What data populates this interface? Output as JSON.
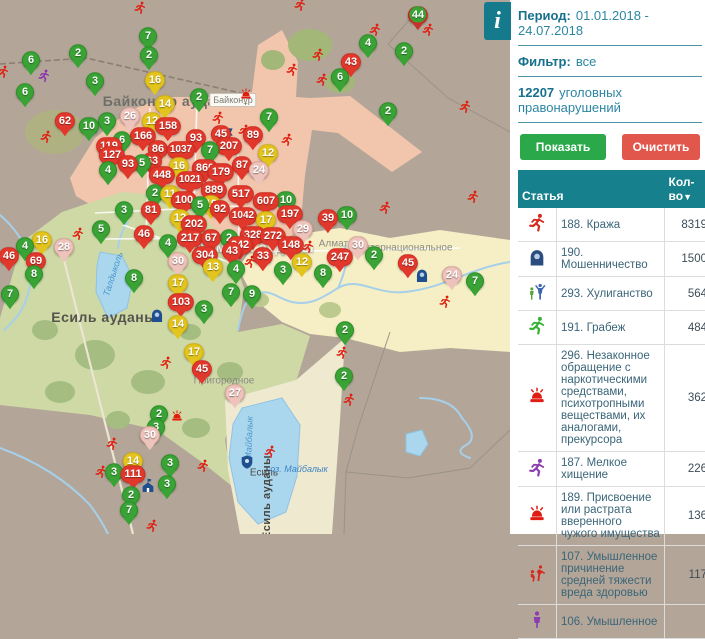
{
  "map": {
    "district_labels": [
      {
        "text": "Байконыр ауданы",
        "x": 170,
        "y": 101,
        "fs": 14,
        "color": "#6f6f6a",
        "rot": 0,
        "shadow": false
      },
      {
        "text": "Алматы ауданы",
        "x": 255,
        "y": 247,
        "fs": 14,
        "color": "#f6f4ec",
        "rot": 0,
        "shadow": true
      },
      {
        "text": "Есиль ауданы",
        "x": 104,
        "y": 317,
        "fs": 14,
        "color": "#55544c",
        "rot": 0,
        "shadow": false
      },
      {
        "text": "Есиль ауданы",
        "x": 267,
        "y": 497,
        "fs": 11,
        "color": "#454540",
        "rot": -90,
        "shadow": false
      }
    ],
    "place_labels": [
      {
        "text": "Байконұр",
        "x": 233,
        "y": 100,
        "fs": 9,
        "color": "#7c7b74",
        "boxed": true
      },
      {
        "text": "Алматы",
        "x": 337,
        "y": 244,
        "fs": 10,
        "color": "#8a8a83"
      },
      {
        "text": "Интернациональное",
        "x": 405,
        "y": 248,
        "fs": 10,
        "color": "#8a8a83"
      },
      {
        "text": "Пригородное",
        "x": 224,
        "y": 381,
        "fs": 10,
        "color": "#8a8a83"
      },
      {
        "text": "Есиль",
        "x": 264,
        "y": 473,
        "fs": 10,
        "color": "#4a4a44"
      },
      {
        "text": "оз. Майбалык",
        "x": 299,
        "y": 469,
        "fs": 9,
        "color": "#3f85c6",
        "italic": true
      },
      {
        "text": "Талдыколь",
        "x": 113,
        "y": 274,
        "fs": 9,
        "color": "#4a97cc",
        "rot": -72,
        "italic": true
      },
      {
        "text": "Майбалык",
        "x": 249,
        "y": 438,
        "fs": 9,
        "color": "#4a97cc",
        "rot": -88,
        "italic": true
      }
    ],
    "markers": [
      {
        "x": 148,
        "y": 38,
        "n": "7",
        "c": "green"
      },
      {
        "x": 149,
        "y": 57,
        "n": "2",
        "c": "green"
      },
      {
        "x": 78,
        "y": 55,
        "n": "2",
        "c": "green"
      },
      {
        "x": 31,
        "y": 62,
        "n": "6",
        "c": "green"
      },
      {
        "x": 25,
        "y": 94,
        "n": "6",
        "c": "green"
      },
      {
        "x": 95,
        "y": 83,
        "n": "3",
        "c": "green"
      },
      {
        "x": 418,
        "y": 17,
        "n": "44",
        "c": "cluster"
      },
      {
        "x": 368,
        "y": 45,
        "n": "4",
        "c": "green"
      },
      {
        "x": 404,
        "y": 53,
        "n": "2",
        "c": "green"
      },
      {
        "x": 351,
        "y": 64,
        "n": "43",
        "c": "red"
      },
      {
        "x": 340,
        "y": 79,
        "n": "6",
        "c": "green"
      },
      {
        "x": 388,
        "y": 113,
        "n": "2",
        "c": "green"
      },
      {
        "x": 155,
        "y": 82,
        "n": "16",
        "c": "yellow"
      },
      {
        "x": 165,
        "y": 106,
        "n": "14",
        "c": "yellow"
      },
      {
        "x": 199,
        "y": 99,
        "n": "2",
        "c": "green"
      },
      {
        "x": 269,
        "y": 119,
        "n": "7",
        "c": "green"
      },
      {
        "x": 130,
        "y": 118,
        "n": "26",
        "c": "pale"
      },
      {
        "x": 107,
        "y": 123,
        "n": "3",
        "c": "green"
      },
      {
        "x": 152,
        "y": 123,
        "n": "12",
        "c": "yellow"
      },
      {
        "x": 168,
        "y": 128,
        "n": "158",
        "c": "red"
      },
      {
        "x": 65,
        "y": 123,
        "n": "62",
        "c": "red"
      },
      {
        "x": 89,
        "y": 128,
        "n": "10",
        "c": "green"
      },
      {
        "x": 143,
        "y": 138,
        "n": "166",
        "c": "red"
      },
      {
        "x": 196,
        "y": 140,
        "n": "93",
        "c": "red"
      },
      {
        "x": 221,
        "y": 136,
        "n": "45",
        "c": "red"
      },
      {
        "x": 229,
        "y": 148,
        "n": "207",
        "c": "red"
      },
      {
        "x": 253,
        "y": 137,
        "n": "89",
        "c": "red"
      },
      {
        "x": 122,
        "y": 142,
        "n": "6",
        "c": "green"
      },
      {
        "x": 109,
        "y": 148,
        "n": "119",
        "c": "red"
      },
      {
        "x": 112,
        "y": 157,
        "n": "127",
        "c": "red"
      },
      {
        "x": 158,
        "y": 151,
        "n": "86",
        "c": "red"
      },
      {
        "x": 181,
        "y": 152,
        "n": "1037",
        "c": "red"
      },
      {
        "x": 210,
        "y": 152,
        "n": "7",
        "c": "green"
      },
      {
        "x": 152,
        "y": 163,
        "n": "63",
        "c": "red"
      },
      {
        "x": 128,
        "y": 166,
        "n": "93",
        "c": "red"
      },
      {
        "x": 268,
        "y": 155,
        "n": "12",
        "c": "yellow"
      },
      {
        "x": 259,
        "y": 172,
        "n": "24",
        "c": "pale"
      },
      {
        "x": 242,
        "y": 167,
        "n": "87",
        "c": "red"
      },
      {
        "x": 142,
        "y": 165,
        "n": "5",
        "c": "green"
      },
      {
        "x": 179,
        "y": 168,
        "n": "16",
        "c": "yellow"
      },
      {
        "x": 205,
        "y": 170,
        "n": "860",
        "c": "red"
      },
      {
        "x": 221,
        "y": 174,
        "n": "179",
        "c": "red"
      },
      {
        "x": 108,
        "y": 172,
        "n": "4",
        "c": "green"
      },
      {
        "x": 162,
        "y": 177,
        "n": "448",
        "c": "red"
      },
      {
        "x": 190,
        "y": 182,
        "n": "1021",
        "c": "red"
      },
      {
        "x": 214,
        "y": 192,
        "n": "889",
        "c": "red"
      },
      {
        "x": 241,
        "y": 196,
        "n": "517",
        "c": "red"
      },
      {
        "x": 155,
        "y": 195,
        "n": "2",
        "c": "green"
      },
      {
        "x": 170,
        "y": 196,
        "n": "11",
        "c": "yellow"
      },
      {
        "x": 184,
        "y": 202,
        "n": "100",
        "c": "red"
      },
      {
        "x": 266,
        "y": 203,
        "n": "607",
        "c": "red"
      },
      {
        "x": 286,
        "y": 202,
        "n": "10",
        "c": "green"
      },
      {
        "x": 200,
        "y": 207,
        "n": "5",
        "c": "green"
      },
      {
        "x": 211,
        "y": 206,
        "n": "19",
        "c": "yellow"
      },
      {
        "x": 220,
        "y": 211,
        "n": "92",
        "c": "red"
      },
      {
        "x": 290,
        "y": 216,
        "n": "197",
        "c": "red"
      },
      {
        "x": 243,
        "y": 218,
        "n": "1042",
        "c": "red"
      },
      {
        "x": 124,
        "y": 212,
        "n": "3",
        "c": "green"
      },
      {
        "x": 151,
        "y": 212,
        "n": "81",
        "c": "red"
      },
      {
        "x": 328,
        "y": 220,
        "n": "39",
        "c": "red"
      },
      {
        "x": 347,
        "y": 217,
        "n": "10",
        "c": "green"
      },
      {
        "x": 180,
        "y": 220,
        "n": "12",
        "c": "yellow"
      },
      {
        "x": 266,
        "y": 222,
        "n": "17",
        "c": "yellow"
      },
      {
        "x": 194,
        "y": 226,
        "n": "202",
        "c": "red"
      },
      {
        "x": 303,
        "y": 231,
        "n": "29",
        "c": "pale"
      },
      {
        "x": 101,
        "y": 231,
        "n": "5",
        "c": "green"
      },
      {
        "x": 144,
        "y": 236,
        "n": "46",
        "c": "red"
      },
      {
        "x": 229,
        "y": 240,
        "n": "2",
        "c": "green"
      },
      {
        "x": 253,
        "y": 237,
        "n": "328",
        "c": "red"
      },
      {
        "x": 273,
        "y": 238,
        "n": "272",
        "c": "red"
      },
      {
        "x": 42,
        "y": 242,
        "n": "16",
        "c": "yellow"
      },
      {
        "x": 25,
        "y": 248,
        "n": "4",
        "c": "green"
      },
      {
        "x": 64,
        "y": 249,
        "n": "28",
        "c": "pale"
      },
      {
        "x": 168,
        "y": 245,
        "n": "4",
        "c": "green"
      },
      {
        "x": 190,
        "y": 240,
        "n": "217",
        "c": "red"
      },
      {
        "x": 211,
        "y": 240,
        "n": "67",
        "c": "red"
      },
      {
        "x": 240,
        "y": 247,
        "n": "242",
        "c": "red"
      },
      {
        "x": 232,
        "y": 253,
        "n": "43",
        "c": "red"
      },
      {
        "x": 291,
        "y": 247,
        "n": "148",
        "c": "red"
      },
      {
        "x": 358,
        "y": 247,
        "n": "30",
        "c": "pale"
      },
      {
        "x": 340,
        "y": 259,
        "n": "247",
        "c": "red"
      },
      {
        "x": 374,
        "y": 257,
        "n": "2",
        "c": "green"
      },
      {
        "x": 9,
        "y": 258,
        "n": "46",
        "c": "red"
      },
      {
        "x": 36,
        "y": 263,
        "n": "69",
        "c": "red"
      },
      {
        "x": 263,
        "y": 258,
        "n": "33",
        "c": "red"
      },
      {
        "x": 205,
        "y": 257,
        "n": "304",
        "c": "red"
      },
      {
        "x": 178,
        "y": 263,
        "n": "30",
        "c": "pale"
      },
      {
        "x": 302,
        "y": 264,
        "n": "12",
        "c": "yellow"
      },
      {
        "x": 408,
        "y": 265,
        "n": "45",
        "c": "red"
      },
      {
        "x": 213,
        "y": 269,
        "n": "13",
        "c": "yellow"
      },
      {
        "x": 236,
        "y": 271,
        "n": "4",
        "c": "green"
      },
      {
        "x": 283,
        "y": 272,
        "n": "3",
        "c": "green"
      },
      {
        "x": 323,
        "y": 275,
        "n": "8",
        "c": "green"
      },
      {
        "x": 34,
        "y": 276,
        "n": "8",
        "c": "green"
      },
      {
        "x": 452,
        "y": 277,
        "n": "24",
        "c": "pale"
      },
      {
        "x": 134,
        "y": 280,
        "n": "8",
        "c": "green"
      },
      {
        "x": 475,
        "y": 283,
        "n": "7",
        "c": "green"
      },
      {
        "x": 178,
        "y": 285,
        "n": "17",
        "c": "yellow"
      },
      {
        "x": 231,
        "y": 294,
        "n": "7",
        "c": "green"
      },
      {
        "x": 252,
        "y": 296,
        "n": "9",
        "c": "green"
      },
      {
        "x": 10,
        "y": 296,
        "n": "7",
        "c": "green"
      },
      {
        "x": 181,
        "y": 304,
        "n": "103",
        "c": "red"
      },
      {
        "x": 204,
        "y": 311,
        "n": "3",
        "c": "green"
      },
      {
        "x": 178,
        "y": 326,
        "n": "14",
        "c": "yellow"
      },
      {
        "x": 345,
        "y": 332,
        "n": "2",
        "c": "green"
      },
      {
        "x": 194,
        "y": 354,
        "n": "17",
        "c": "yellow"
      },
      {
        "x": 202,
        "y": 371,
        "n": "45",
        "c": "red"
      },
      {
        "x": 344,
        "y": 378,
        "n": "2",
        "c": "green"
      },
      {
        "x": 235,
        "y": 395,
        "n": "27",
        "c": "pale"
      },
      {
        "x": 159,
        "y": 416,
        "n": "2",
        "c": "green"
      },
      {
        "x": 156,
        "y": 429,
        "n": "3",
        "c": "green"
      },
      {
        "x": 150,
        "y": 437,
        "n": "30",
        "c": "pale"
      },
      {
        "x": 133,
        "y": 463,
        "n": "14",
        "c": "yellow"
      },
      {
        "x": 170,
        "y": 465,
        "n": "3",
        "c": "green"
      },
      {
        "x": 114,
        "y": 474,
        "n": "3",
        "c": "green"
      },
      {
        "x": 133,
        "y": 476,
        "n": "111",
        "c": "red"
      },
      {
        "x": 167,
        "y": 486,
        "n": "3",
        "c": "green"
      },
      {
        "x": 131,
        "y": 497,
        "n": "2",
        "c": "green"
      },
      {
        "x": 129,
        "y": 512,
        "n": "7",
        "c": "green"
      }
    ],
    "icons": [
      {
        "x": 140,
        "y": 8,
        "t": "runner",
        "c": "#e11d0e"
      },
      {
        "x": 300,
        "y": 5,
        "t": "runner",
        "c": "#e11d0e"
      },
      {
        "x": 375,
        "y": 30,
        "t": "runner",
        "c": "#e11d0e"
      },
      {
        "x": 428,
        "y": 30,
        "t": "runner",
        "c": "#e11d0e"
      },
      {
        "x": 318,
        "y": 55,
        "t": "runner",
        "c": "#e11d0e"
      },
      {
        "x": 292,
        "y": 70,
        "t": "runner",
        "c": "#e11d0e"
      },
      {
        "x": 322,
        "y": 80,
        "t": "runner",
        "c": "#e11d0e"
      },
      {
        "x": 3,
        "y": 72,
        "t": "runner",
        "c": "#e11d0e"
      },
      {
        "x": 44,
        "y": 76,
        "t": "runner",
        "c": "#8d2fb0"
      },
      {
        "x": 465,
        "y": 107,
        "t": "runner",
        "c": "#e11d0e"
      },
      {
        "x": 246,
        "y": 95,
        "t": "siren",
        "c": "#e11d0e"
      },
      {
        "x": 218,
        "y": 118,
        "t": "runner",
        "c": "#e11d0e"
      },
      {
        "x": 244,
        "y": 131,
        "t": "runner",
        "c": "#e11d0e"
      },
      {
        "x": 287,
        "y": 140,
        "t": "runner",
        "c": "#e11d0e"
      },
      {
        "x": 46,
        "y": 137,
        "t": "runner",
        "c": "#e11d0e"
      },
      {
        "x": 228,
        "y": 135,
        "t": "flag",
        "c": "#1f4f8f"
      },
      {
        "x": 473,
        "y": 197,
        "t": "runner",
        "c": "#e11d0e"
      },
      {
        "x": 385,
        "y": 208,
        "t": "runner",
        "c": "#e11d0e"
      },
      {
        "x": 78,
        "y": 234,
        "t": "runner",
        "c": "#e11d0e"
      },
      {
        "x": 250,
        "y": 262,
        "t": "runner",
        "c": "#e11d0e"
      },
      {
        "x": 308,
        "y": 247,
        "t": "runner",
        "c": "#e11d0e"
      },
      {
        "x": 422,
        "y": 276,
        "t": "hooded",
        "c": "#1f4f8f"
      },
      {
        "x": 445,
        "y": 302,
        "t": "runner",
        "c": "#e11d0e"
      },
      {
        "x": 157,
        "y": 316,
        "t": "hooded",
        "c": "#1f4f8f"
      },
      {
        "x": 342,
        "y": 353,
        "t": "runner",
        "c": "#e11d0e"
      },
      {
        "x": 166,
        "y": 363,
        "t": "runner",
        "c": "#e11d0e"
      },
      {
        "x": 349,
        "y": 400,
        "t": "runner",
        "c": "#e11d0e"
      },
      {
        "x": 177,
        "y": 417,
        "t": "siren",
        "c": "#e11d0e"
      },
      {
        "x": 112,
        "y": 444,
        "t": "runner",
        "c": "#e11d0e"
      },
      {
        "x": 270,
        "y": 452,
        "t": "runner",
        "c": "#e11d0e"
      },
      {
        "x": 247,
        "y": 462,
        "t": "badge",
        "c": "#1f4f8f"
      },
      {
        "x": 101,
        "y": 472,
        "t": "runner",
        "c": "#e11d0e"
      },
      {
        "x": 203,
        "y": 466,
        "t": "runner",
        "c": "#e11d0e"
      },
      {
        "x": 148,
        "y": 486,
        "t": "house",
        "c": "#1f4f8f"
      },
      {
        "x": 152,
        "y": 526,
        "t": "runner",
        "c": "#e11d0e"
      }
    ]
  },
  "sidebar": {
    "info_icon": "i",
    "period_label": "Период:",
    "period_value": "01.01.2018 - 24.07.2018",
    "filter_label": "Фильтр:",
    "filter_value": "все",
    "total_count": "12207",
    "total_text": "уголовных правонарушений",
    "show_button": "Показать",
    "clear_button": "Очистить",
    "table": {
      "col_article": "Статья",
      "col_count": "Кол-во",
      "sort_icon": "▼",
      "rows": [
        {
          "icon": "runner",
          "color": "#d6281c",
          "label": "188. Кража",
          "count": "8319"
        },
        {
          "icon": "hooded",
          "color": "#2a4d7f",
          "label": "190. Мошенничество",
          "count": "1500"
        },
        {
          "icon": "hooligan",
          "color": "#3f67b1",
          "label": "293. Хулиганство",
          "count": "564"
        },
        {
          "icon": "runner",
          "color": "#35b234",
          "label": "191. Грабеж",
          "count": "484"
        },
        {
          "icon": "siren",
          "color": "#e01d12",
          "label": "296. Незаконное обращение с наркотическими средствами, психотропными веществами, их аналогами, прекурсора",
          "count": "362"
        },
        {
          "icon": "runner",
          "color": "#8d3daf",
          "label": "187. Мелкое хищение",
          "count": "226"
        },
        {
          "icon": "siren",
          "color": "#e01d12",
          "label": "189. Присвоение или растрата вверенного чужого имущества",
          "count": "136"
        },
        {
          "icon": "fight",
          "color": "#d6281c",
          "label": "107. Умышленное причинение средней тяжести вреда здоровью",
          "count": "117"
        },
        {
          "icon": "person",
          "color": "#8d3daf",
          "label": "106. Умышленное",
          "count": ""
        }
      ]
    }
  }
}
